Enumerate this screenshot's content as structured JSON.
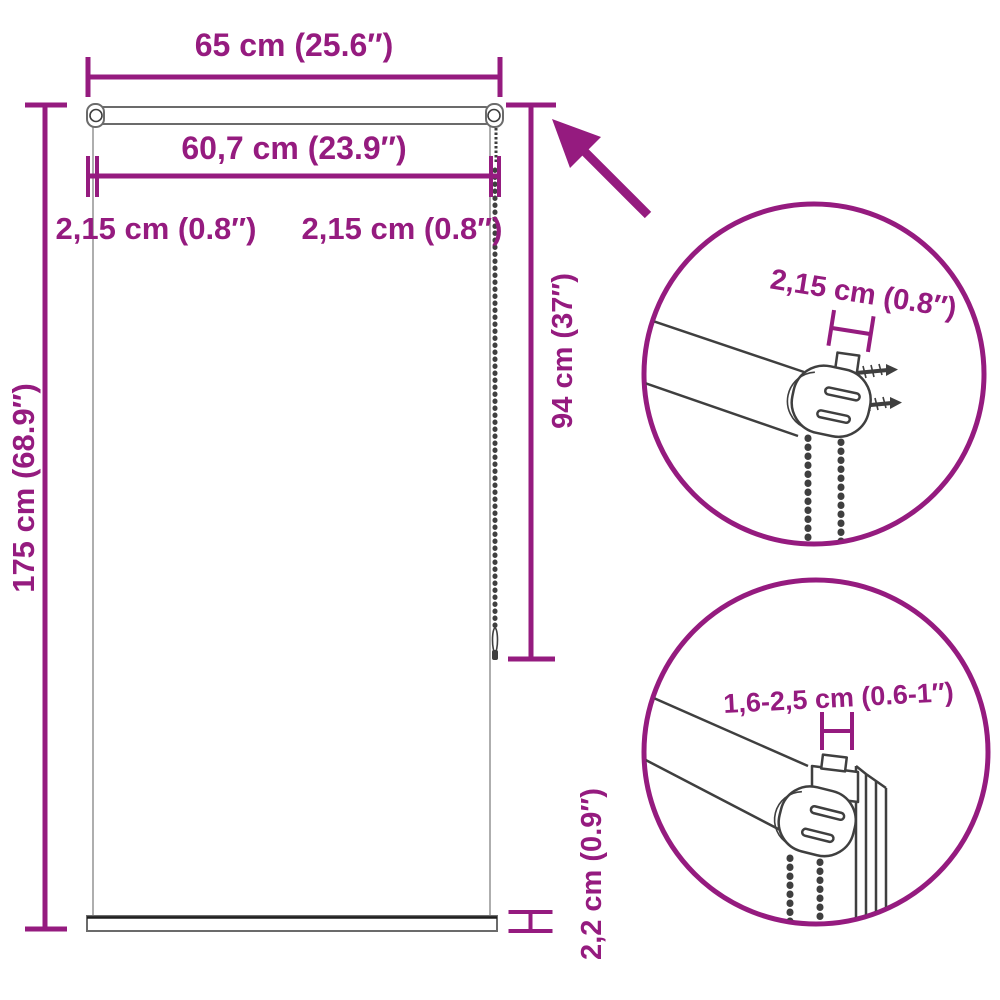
{
  "colors": {
    "accent": "#951b7f",
    "artwork": "#3f3f3f",
    "fabric": "#9a9a9a"
  },
  "labels": {
    "total_width": "65 cm (25.6″)",
    "fabric_width": "60,7 cm (23.9″)",
    "side_gap_left": "2,15 cm (0.8″)",
    "side_gap_right": "2,15 cm (0.8″)",
    "total_height": "175 cm (68.9″)",
    "chain_length": "94 cm (37″)",
    "bottom_bar_height": "2,2 cm (0.9″)",
    "detail_top_width": "2,15 cm (0.8″)",
    "detail_bottom_range": "1,6-2,5 cm (0.6-1″)"
  }
}
